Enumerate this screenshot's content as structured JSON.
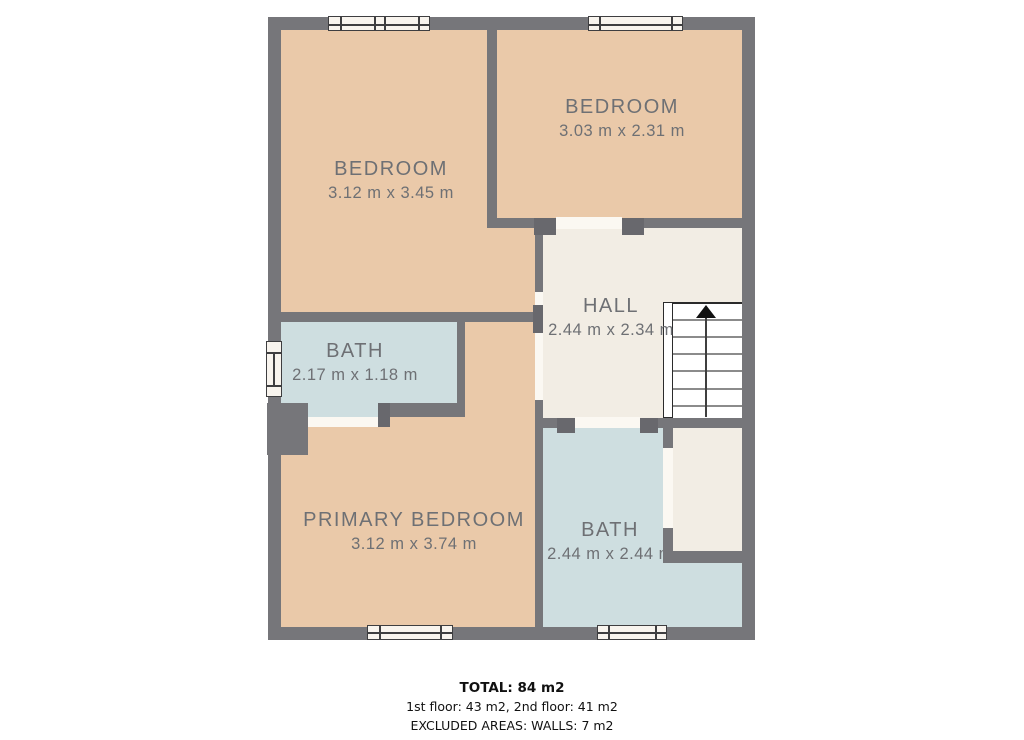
{
  "plan": {
    "title": "2nd floor plan",
    "rooms": [
      {
        "name": "BEDROOM",
        "dims": "3.12 m x 3.45 m"
      },
      {
        "name": "BEDROOM",
        "dims": "3.03 m x 2.31 m"
      },
      {
        "name": "HALL",
        "dims": "2.44 m x 2.34 m"
      },
      {
        "name": "BATH",
        "dims": "2.17 m x 1.18 m"
      },
      {
        "name": "PRIMARY BEDROOM",
        "dims": "3.12 m x 3.74 m"
      },
      {
        "name": "BATH",
        "dims": "2.44 m x 2.44 m"
      }
    ],
    "stairs": {
      "arrow_icon": "up-arrow",
      "direction": "up",
      "treads": 7
    }
  },
  "footer": {
    "total": "TOTAL: 84 m2",
    "floors": "1st floor: 43 m2, 2nd floor: 41 m2",
    "excluded": "EXCLUDED AREAS: WALLS: 7 m2"
  },
  "colors": {
    "wall": "#76767a",
    "door_jamb": "#68686d",
    "floor_peach": "#eac9a9",
    "floor_blue": "#cedee0",
    "floor_cream": "#f2ede4",
    "window_fill": "#f8f4ee",
    "outline_dark": "#3e3e40",
    "label_text": "#6e7074",
    "footer_text": "#111111"
  }
}
